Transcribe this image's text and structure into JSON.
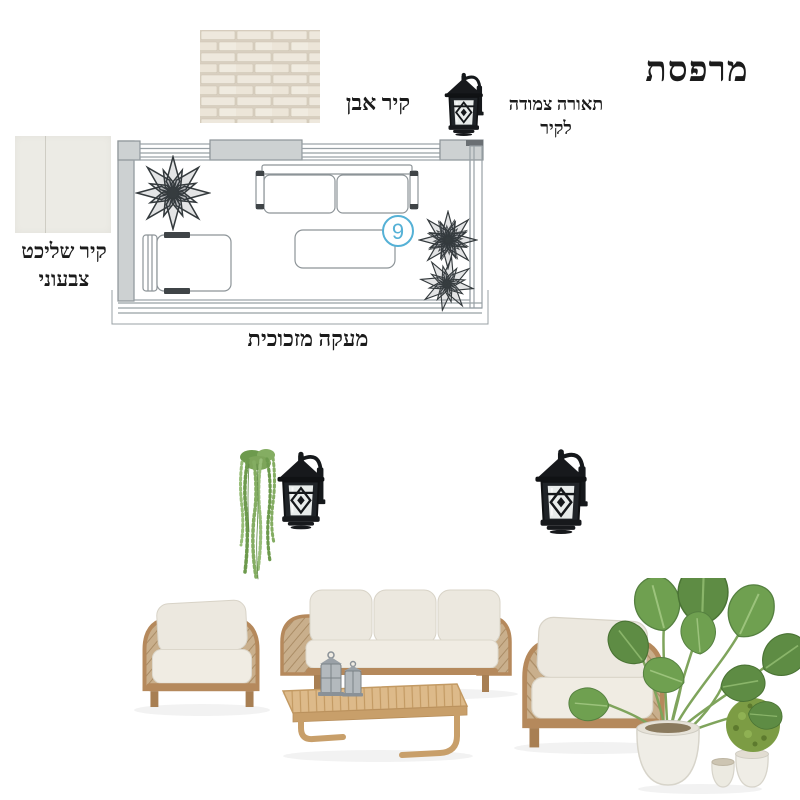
{
  "title": "מרפסת",
  "labels": {
    "stone_wall": "קיר אבן",
    "wall_light": [
      "תאורה צמודה",
      "לקיר"
    ],
    "plaster_wall": [
      "קיר שליכט",
      "צבעוני"
    ],
    "glass_railing": "מעקה מזכוכית"
  },
  "floorplan": {
    "marker_number": "9",
    "marker_color": "#55b1d6"
  },
  "colors": {
    "background": "#ffffff",
    "text": "#1b1b1b",
    "plan_line": "#98a0a5",
    "plan_wall_fill": "#cdd1d2",
    "brick_fill": "#eee8dd",
    "brick_mortar": "#d8cfc0",
    "plaster_swatch": "#ecebe5",
    "lantern_black": "#17191c",
    "wood_frame": "#b5895c",
    "rope_weave": "#c9af8c",
    "cushion": "#ece8df",
    "table_wood": "#ddba8a",
    "leaf_green": "#5e8c44",
    "pot_white": "#efede6",
    "shrub_green": "#7c9c44"
  }
}
